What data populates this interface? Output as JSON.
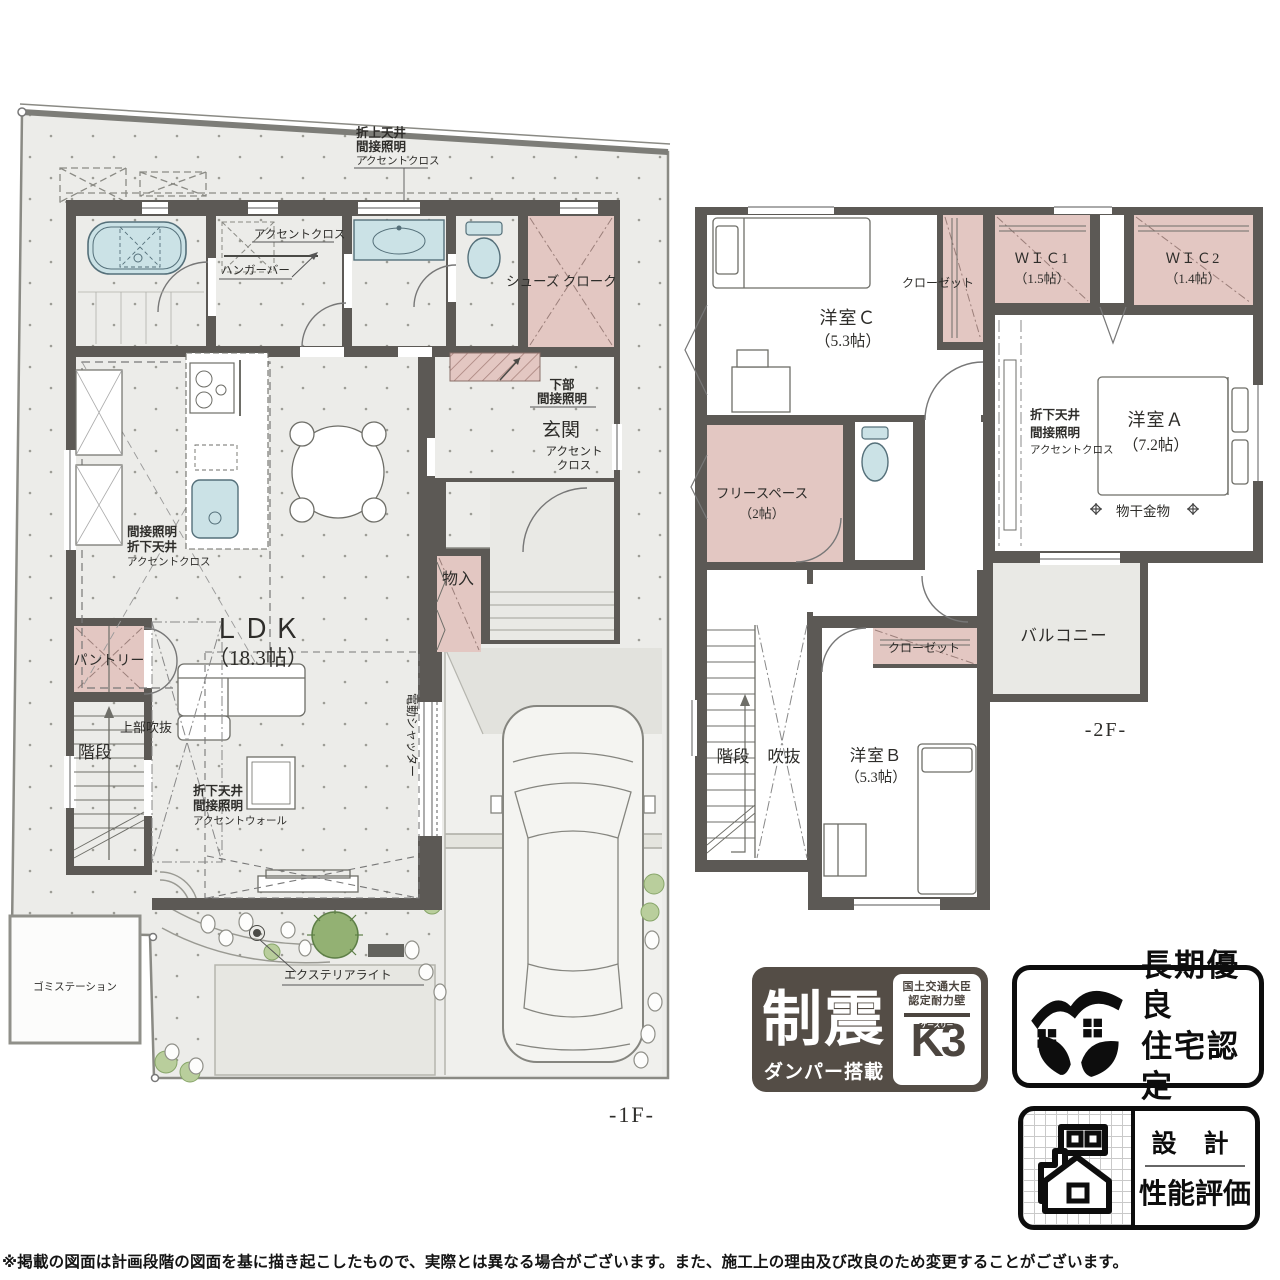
{
  "floors": {
    "f1": {
      "floor_label": "-1F-",
      "ldk_name": "ＬＤＫ",
      "ldk_size": "（18.3帖）",
      "genkan": "玄関",
      "shoes_cloak": "シューズ クローク",
      "pantry": "パントリー",
      "stairs": "階段",
      "joubu_fukinuke": "上部吹抜",
      "monoire": "物入",
      "accent_cross": "アクセントクロス",
      "hanger_bar": "ハンガーバー",
      "oriage": [
        "折上天井",
        "間接照明",
        "アクセントクロス"
      ],
      "kabu": [
        "下部",
        "間接照明"
      ],
      "genkan_accent": [
        "アクセント",
        "クロス"
      ],
      "orisage_kitchen": [
        "間接照明",
        "折下天井",
        "アクセントクロス"
      ],
      "orisage_living": [
        "折下天井",
        "間接照明",
        "アクセントウォール"
      ],
      "electric_shutter": "電動シャッター",
      "exterior_light": "エクステリアライト",
      "gomi_station": "ゴミステーション"
    },
    "f2": {
      "floor_label": "-2F-",
      "room_a_name": "洋室Ａ",
      "room_a_size": "（7.2帖）",
      "room_b_name": "洋室Ｂ",
      "room_b_size": "（5.3帖）",
      "room_c_name": "洋室Ｃ",
      "room_c_size": "（5.3帖）",
      "wic1_name": "ＷＩＣ1",
      "wic1_size": "（1.5帖）",
      "wic2_name": "ＷＩＣ2",
      "wic2_size": "（1.4帖）",
      "free_space_name": "フリースペース",
      "free_space_size": "（2帖）",
      "closet_c": "クローゼット",
      "closet_b": "クローゼット",
      "balcony": "バルコニー",
      "stairs": "階段",
      "fukinuke": "吹抜",
      "monohoshi": "物干金物",
      "orisage": [
        "折下天井",
        "間接照明",
        "アクセントクロス"
      ]
    }
  },
  "badges": {
    "seishin": {
      "title": "制震",
      "subtitle": "ダンパー搭載",
      "cert_line1": "国土交通大臣",
      "cert_line2": "認定耐力壁",
      "mark": "K3",
      "mark_ruby": "ケースリー"
    },
    "choki": {
      "line1": "長期優良",
      "line2": "住宅認定"
    },
    "sekkei": {
      "line1": "設 計",
      "line2": "性能評価"
    }
  },
  "disclaimer": "※掲載の図面は計画段階の図面を基に描き起こしたもので、実際とは異なる場合がございます。また、施工上の理由及び改良のため変更することがございます。"
}
